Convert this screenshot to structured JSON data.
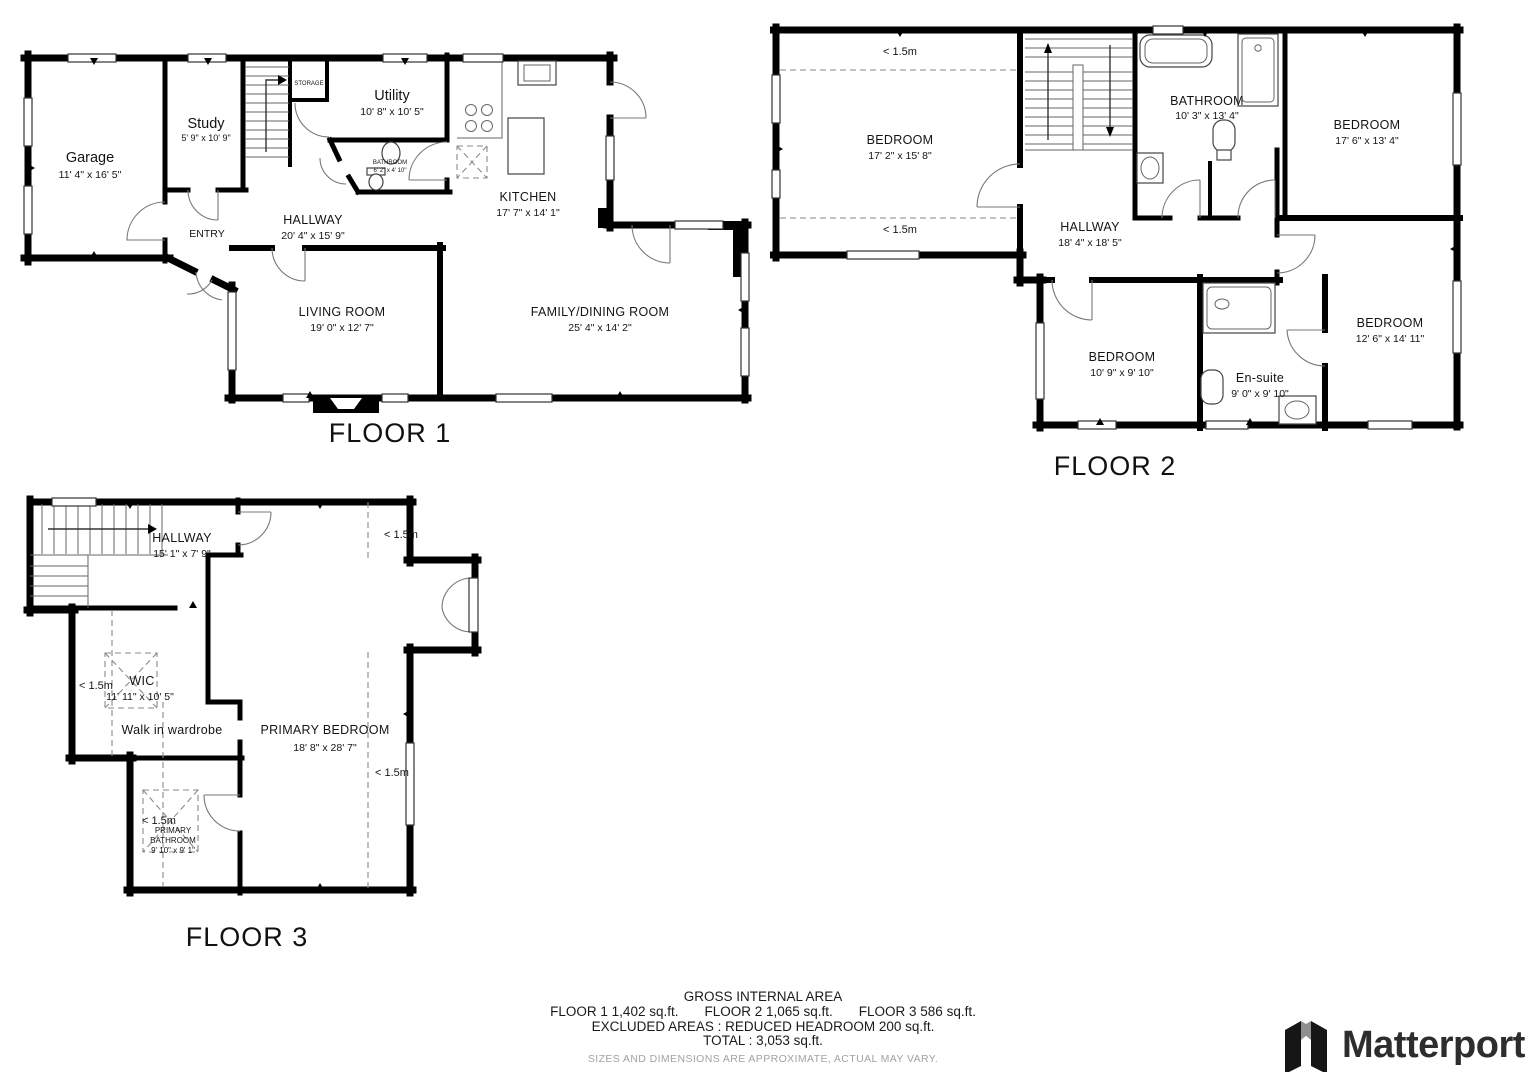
{
  "headroom_label": "< 1.5m",
  "colors": {
    "walls": "#000000",
    "text": "#141414",
    "faded": "#a2a2a2"
  },
  "floors": [
    {
      "label": "FLOOR 1",
      "rooms": {
        "garage": {
          "name": "Garage",
          "dims": "11' 4\" x 16' 5\""
        },
        "study": {
          "name": "Study",
          "dims": "5' 9\" x 10' 9\""
        },
        "storage": {
          "name": "STORAGE"
        },
        "utility": {
          "name": "Utility",
          "dims": "10' 8\" x 10' 5\""
        },
        "bathroom": {
          "name": "BATHROOM",
          "dims": "6' 2\" x 4' 10\""
        },
        "kitchen": {
          "name": "KITCHEN",
          "dims": "17' 7\" x 14' 1\""
        },
        "hallway": {
          "name": "HALLWAY",
          "dims": "20' 4\" x 15' 9\""
        },
        "entry": {
          "name": "ENTRY"
        },
        "living": {
          "name": "LIVING ROOM",
          "dims": "19' 0\" x 12' 7\""
        },
        "family": {
          "name": "FAMILY/DINING ROOM",
          "dims": "25' 4\" x 14' 2\""
        }
      }
    },
    {
      "label": "FLOOR 2",
      "headroom": "< 1.5m",
      "rooms": {
        "bedroom1": {
          "name": "BEDROOM",
          "dims": "17' 2\" x 15' 8\""
        },
        "bathroom": {
          "name": "BATHROOM",
          "dims": "10' 3\" x 13' 4\""
        },
        "bedroom2": {
          "name": "BEDROOM",
          "dims": "17' 6\" x 13' 4\""
        },
        "hallway": {
          "name": "HALLWAY",
          "dims": "18' 4\" x 18' 5\""
        },
        "bedroom3": {
          "name": "BEDROOM",
          "dims": "10' 9\" x 9' 10\""
        },
        "ensuite": {
          "name": "En-suite",
          "dims": "9' 0\" x 9' 10\""
        },
        "bedroom4": {
          "name": "BEDROOM",
          "dims": "12' 6\" x 14' 11\""
        }
      }
    },
    {
      "label": "FLOOR 3",
      "headroom": "< 1.5m",
      "rooms": {
        "hallway": {
          "name": "HALLWAY",
          "dims": "15' 1\" x 7' 9\""
        },
        "wic": {
          "name": "WIC",
          "dims": "11' 11\" x 10' 5\"",
          "caption": "Walk in wardrobe"
        },
        "primary_bedroom": {
          "name": "PRIMARY BEDROOM",
          "dims": "18' 8\" x 28' 7\""
        },
        "primary_bathroom": {
          "name_line1": "PRIMARY",
          "name_line2": "BATHROOM",
          "dims": "9' 10\" x 9' 1\""
        }
      }
    }
  ],
  "footer": {
    "title": "GROSS INTERNAL AREA",
    "areas": [
      "FLOOR 1 1,402 sq.ft.",
      "FLOOR 2 1,065 sq.ft.",
      "FLOOR 3 586 sq.ft."
    ],
    "excluded": "EXCLUDED AREAS :  REDUCED HEADROOM 200 sq.ft.",
    "total": "TOTAL :  3,053 sq.ft.",
    "disclaimer": "SIZES AND DIMENSIONS ARE APPROXIMATE, ACTUAL MAY VARY."
  },
  "brand": {
    "name": "Matterport"
  }
}
